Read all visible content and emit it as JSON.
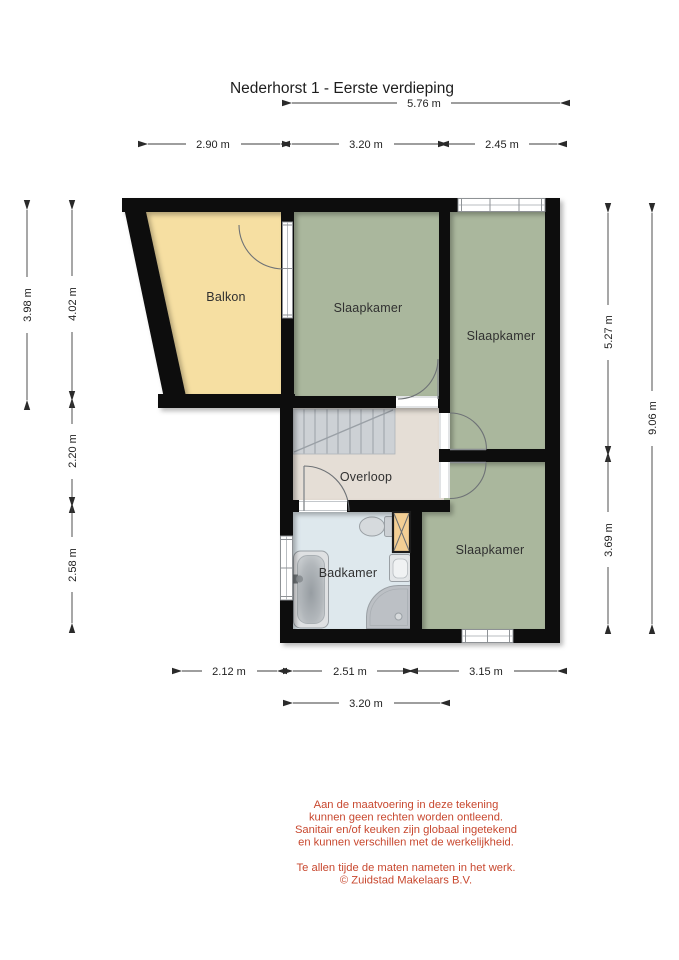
{
  "title": "Nederhorst 1 - Eerste verdieping",
  "floorplan": {
    "rooms": [
      {
        "id": "balkon",
        "label": "Balkon"
      },
      {
        "id": "slaapkamer-mid",
        "label": "Slaapkamer"
      },
      {
        "id": "slaapkamer-right",
        "label": "Slaapkamer"
      },
      {
        "id": "slaapkamer-bottom",
        "label": "Slaapkamer"
      },
      {
        "id": "overloop",
        "label": "Overloop"
      },
      {
        "id": "badkamer",
        "label": "Badkamer"
      }
    ],
    "colors": {
      "balkon": "#f6dfa2",
      "bedroom": "#aab79d",
      "hallway": "#e5ded6",
      "bathroom": "#dee8ed",
      "stairs": "#cdd1d5",
      "duct": "#f3cf94",
      "wall": "#101010",
      "disclaimer_text": "#c8482f"
    }
  },
  "dimensions": {
    "top_total": "5.76 m",
    "top_balkon": "2.90 m",
    "top_mid": "3.20 m",
    "top_right": "2.45 m",
    "left_outer": "3.98 m",
    "left_upper": "4.02 m",
    "left_middle": "2.20 m",
    "left_lower": "2.58 m",
    "right_upper": "5.27 m",
    "right_lower": "3.69 m",
    "right_outer": "9.06 m",
    "bottom_left": "2.12 m",
    "bottom_middle": "2.51 m",
    "bottom_right": "3.15 m",
    "bottom_inner": "3.20 m"
  },
  "disclaimer": {
    "line1": "Aan de maatvoering in deze tekening",
    "line2": "kunnen geen rechten worden ontleend.",
    "line3": "Sanitair en/of keuken zijn globaal ingetekend",
    "line4": "en kunnen verschillen met de werkelijkheid."
  },
  "note": {
    "line1": "Te allen tijde de maten nameten in het werk.",
    "line2": "© Zuidstad Makelaars B.V."
  }
}
